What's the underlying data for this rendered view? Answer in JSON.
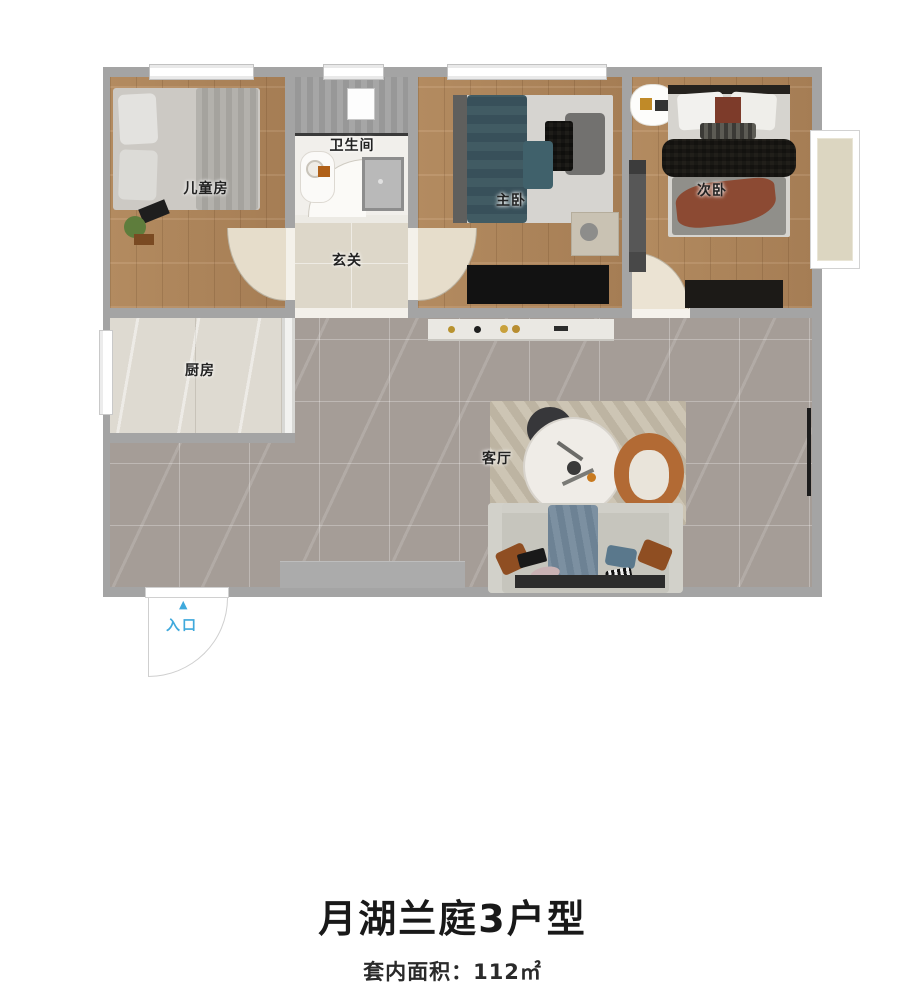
{
  "title": "月湖兰庭3户型",
  "subtitle": "套内面积：112㎡",
  "rooms": {
    "children": {
      "label": "儿童房"
    },
    "bathroom": {
      "label": "卫生间"
    },
    "hallway": {
      "label": "玄关"
    },
    "master": {
      "label": "主卧"
    },
    "second": {
      "label": "次卧"
    },
    "kitchen": {
      "label": "厨房"
    },
    "living": {
      "label": "客厅"
    }
  },
  "entrance": {
    "label": "入口",
    "arrow": "▲",
    "arrow_color": "#3fa9dc"
  },
  "colors": {
    "wall": "#a4a4a4",
    "wood_floor": "#b1895e",
    "marble_floor": "#a59d97",
    "entrance_accent": "#3fa9dc"
  }
}
